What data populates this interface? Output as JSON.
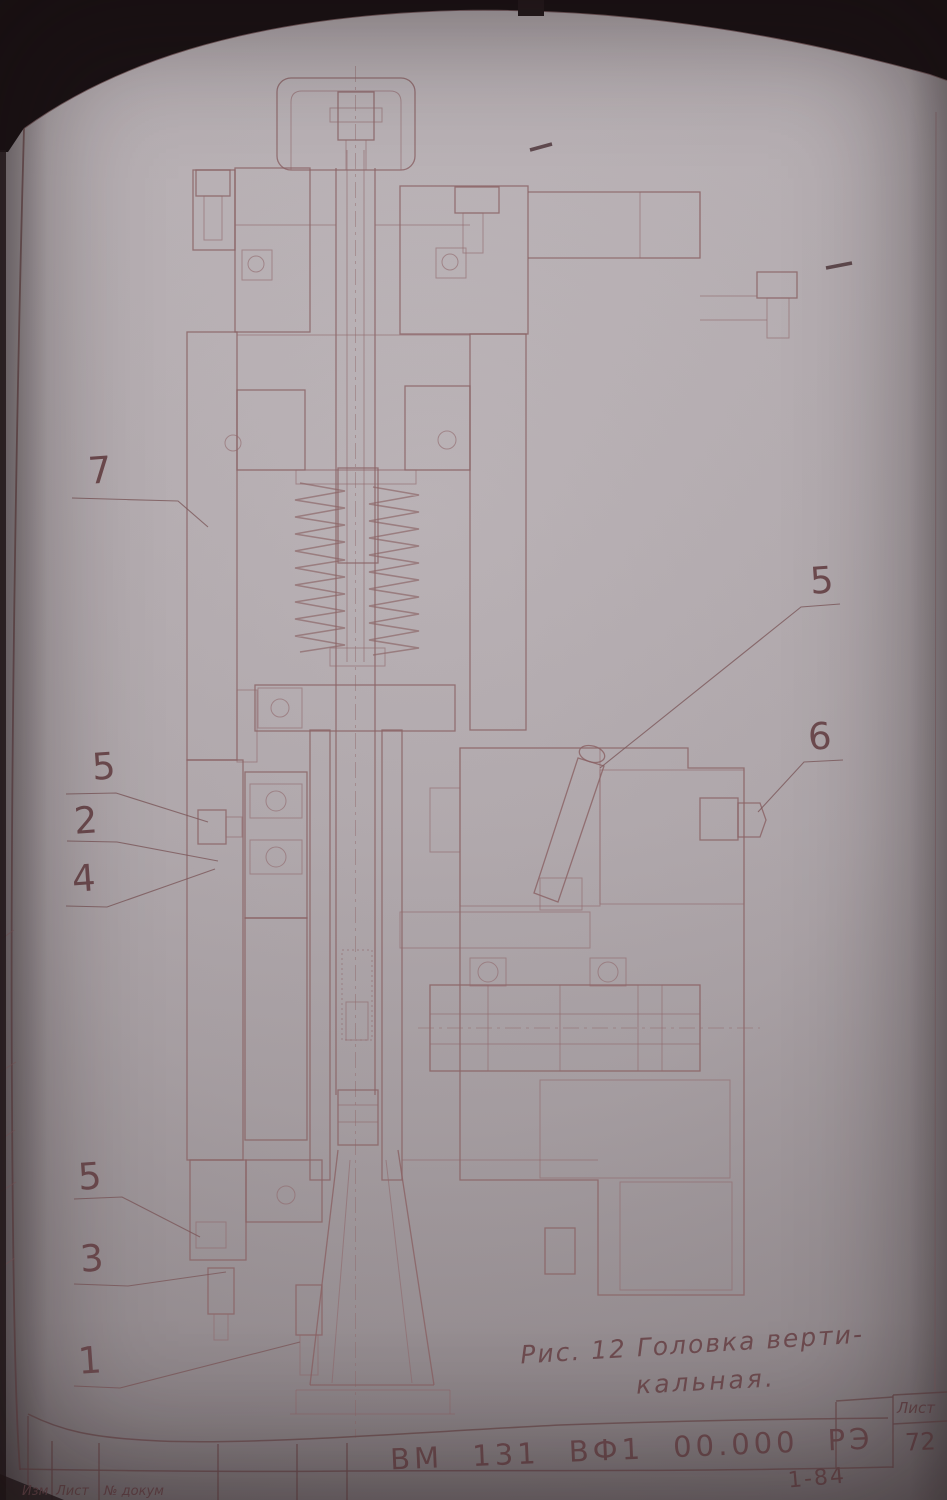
{
  "document": {
    "document_number": "ВМ 131 ВФ1  00.000 РЭ",
    "sheet_label": "Лист",
    "sheet_number": "72",
    "edition_mark": "1-84"
  },
  "figure": {
    "caption_line1": "Рис. 12  Головка верти-",
    "caption_line2": "кальная.",
    "callouts": [
      "7",
      "5",
      "2",
      "4",
      "5",
      "6",
      "5",
      "3",
      "1"
    ]
  },
  "title_block": {
    "revision_columns": [
      "Изм",
      "Лист",
      "№ докум"
    ]
  },
  "colors": {
    "paper": "#b4acb0",
    "ink": "#8a6264",
    "handwriting": "#6d4b4f",
    "background": "#120d0e"
  }
}
